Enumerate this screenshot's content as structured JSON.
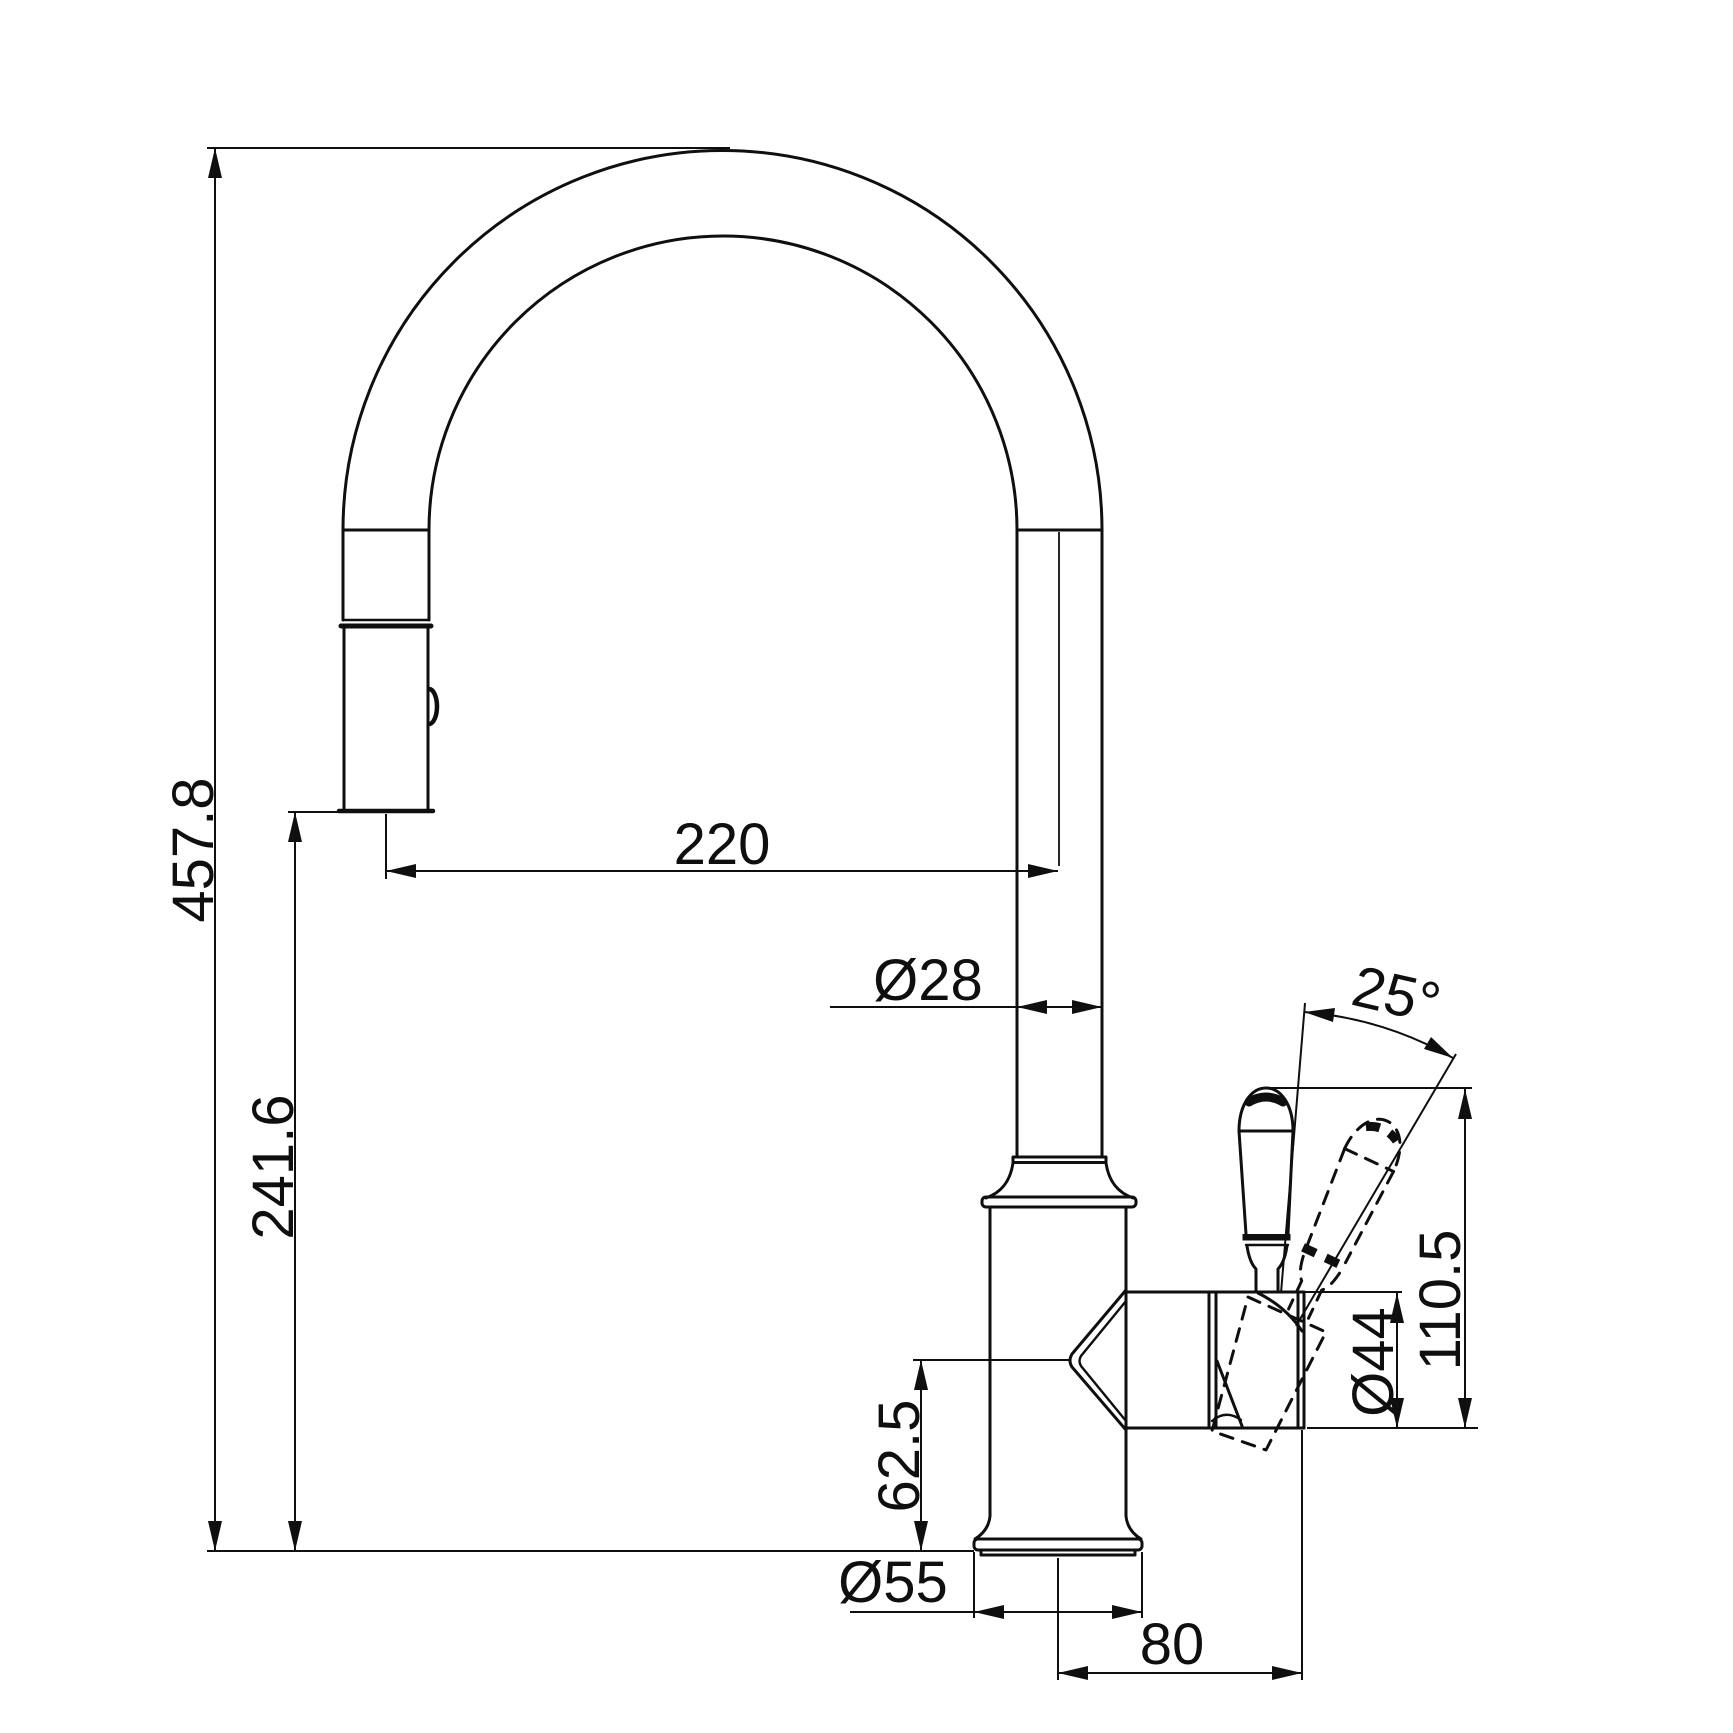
{
  "drawing": {
    "background_color": "#ffffff",
    "line_color": "#0f0f0f",
    "labels": {
      "overall_height": "457.8",
      "outlet_height": "241.6",
      "spout_reach": "220",
      "spout_tube_diameter": "Ø28",
      "handle_swing_angle": "25°",
      "handle_top_height": "110.5",
      "valve_body_diameter": "Ø44",
      "body_section_height": "62.5",
      "base_diameter": "Ø55",
      "handle_offset": "80"
    }
  }
}
